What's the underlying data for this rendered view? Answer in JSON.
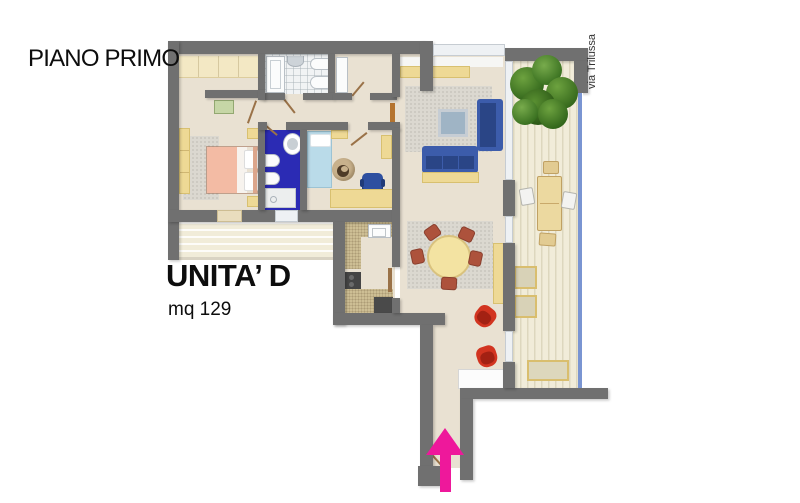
{
  "page": {
    "background": "#ffffff"
  },
  "labels": {
    "floor_title": "PIANO PRIMO",
    "unit_name": "UNITA’ D",
    "unit_area": "mq 129",
    "street_name": "via Trilussa"
  },
  "colors": {
    "page_bg": "#ffffff",
    "wall": "#707070",
    "floor": "#e9e1d2",
    "decking": "#f1ecd9",
    "rug_gray": "#dbd8d0",
    "counter_tan": "#cdbe94",
    "bath_blue": "#2b2bb4",
    "arrow_magenta": "#ee189b",
    "sofa_blue": "#3c5cab",
    "bed_pink": "#f3bba4",
    "bed_light_blue": "#badbe9",
    "furniture_yellow": "#eed995",
    "chair_red": "#d23420",
    "railing_blue": "#7a95d2",
    "tree_green": "#467e25"
  }
}
